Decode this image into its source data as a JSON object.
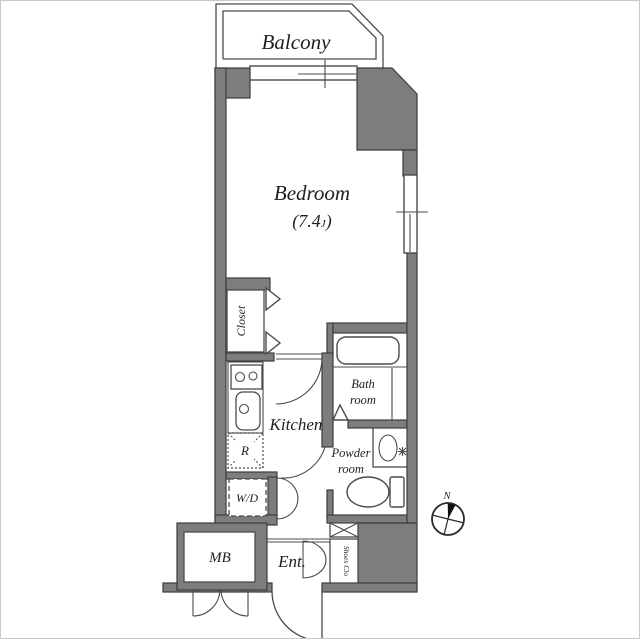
{
  "type": "apartment-floor-plan",
  "colors": {
    "wall_fill": "#7d7d7d",
    "wall_outline": "#3c3c3c",
    "line": "#4b4b4b",
    "text": "#1f1f1f",
    "background": "#ffffff",
    "compass_fill": "#111111"
  },
  "labels": {
    "balcony": "Balcony",
    "bedroom": "Bedroom",
    "bedroom_size_open": "(7.4",
    "bedroom_size_unit": "J",
    "bedroom_size_close": ")",
    "closet": "Closet",
    "kitchen": "Kitchen",
    "bath_line1": "Bath",
    "bath_line2": "room",
    "powder_line1": "Powder",
    "powder_line2": "room",
    "refrigerator": "R",
    "washer_dryer": "W/D",
    "meter_box": "MB",
    "entrance": "Ent.",
    "shoes_closet": "Shoes Clo",
    "north": "N"
  },
  "rooms": [
    {
      "name": "Balcony"
    },
    {
      "name": "Bedroom",
      "size_tatami": "7.4J"
    },
    {
      "name": "Closet"
    },
    {
      "name": "Kitchen"
    },
    {
      "name": "Bath room"
    },
    {
      "name": "Powder room"
    },
    {
      "name": "Ent."
    },
    {
      "name": "Shoes Clo"
    },
    {
      "name": "MB"
    },
    {
      "name": "W/D"
    },
    {
      "name": "R"
    }
  ]
}
